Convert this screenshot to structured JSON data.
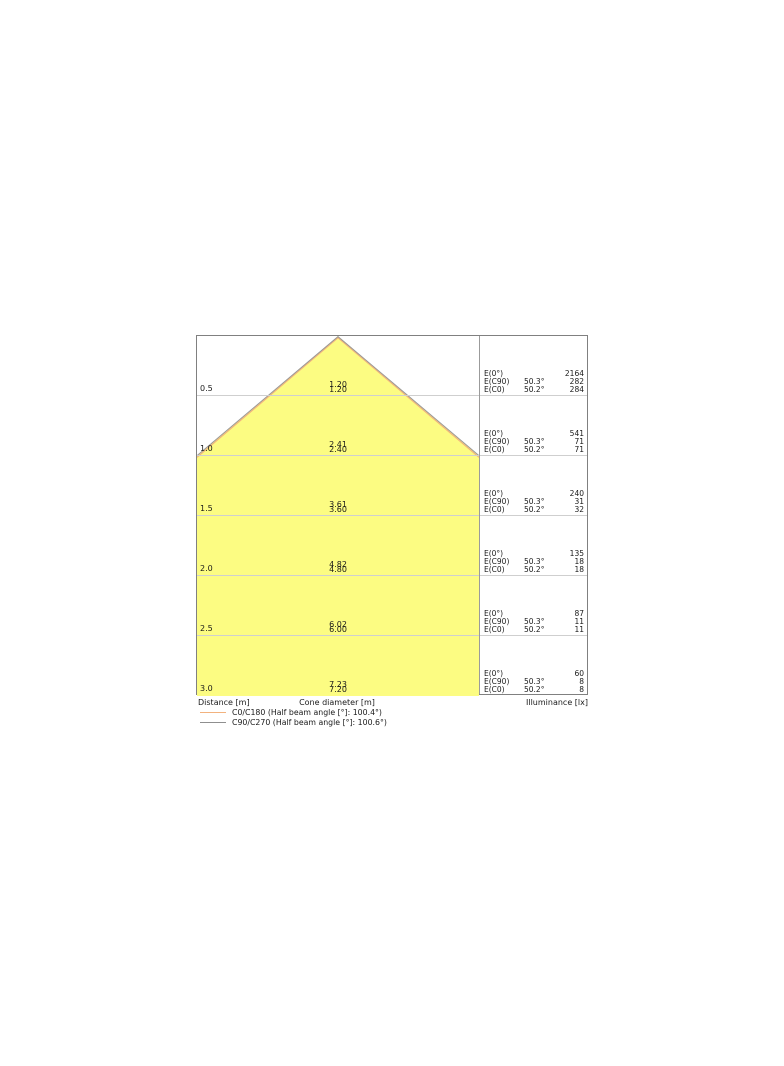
{
  "chart_data": {
    "type": "area",
    "subtype": "luminaire-cone-diagram",
    "axes": {
      "distance_label": "Distance [m]",
      "cone_diameter_label": "Cone diameter [m]",
      "illuminance_label": "Illuminance [lx]"
    },
    "illuminance_row_labels": {
      "e0": "E(0°)",
      "ec90": "E(C90)",
      "ec0": "E(C0)"
    },
    "rows": [
      {
        "distance": "0.5",
        "diameter_c90_c270": "1.20",
        "diameter_c0_c180": "1.20",
        "e0": "2164",
        "ec90_angle": "50.3°",
        "ec90": "282",
        "ec0_angle": "50.2°",
        "ec0": "284"
      },
      {
        "distance": "1.0",
        "diameter_c90_c270": "2.41",
        "diameter_c0_c180": "2.40",
        "e0": "541",
        "ec90_angle": "50.3°",
        "ec90": "71",
        "ec0_angle": "50.2°",
        "ec0": "71"
      },
      {
        "distance": "1.5",
        "diameter_c90_c270": "3.61",
        "diameter_c0_c180": "3.60",
        "e0": "240",
        "ec90_angle": "50.3°",
        "ec90": "31",
        "ec0_angle": "50.2°",
        "ec0": "32"
      },
      {
        "distance": "2.0",
        "diameter_c90_c270": "4.82",
        "diameter_c0_c180": "4.80",
        "e0": "135",
        "ec90_angle": "50.3°",
        "ec90": "18",
        "ec0_angle": "50.2°",
        "ec0": "18"
      },
      {
        "distance": "2.5",
        "diameter_c90_c270": "6.02",
        "diameter_c0_c180": "6.00",
        "e0": "87",
        "ec90_angle": "50.3°",
        "ec90": "11",
        "ec0_angle": "50.2°",
        "ec0": "11"
      },
      {
        "distance": "3.0",
        "diameter_c90_c270": "7.23",
        "diameter_c0_c180": "7.20",
        "e0": "60",
        "ec90_angle": "50.3°",
        "ec90": "8",
        "ec0_angle": "50.2°",
        "ec0": "8"
      }
    ],
    "legend": [
      {
        "label": "C0/C180 (Half beam angle [°]: 100.4°)",
        "color": "#f2b27e"
      },
      {
        "label": "C90/C270 (Half beam angle [°]: 100.6°)",
        "color": "#8f8f8f"
      }
    ],
    "colors": {
      "cone_fill": "#fcfc82",
      "grid_line": "#cfcfcf",
      "frame": "#808080"
    }
  }
}
